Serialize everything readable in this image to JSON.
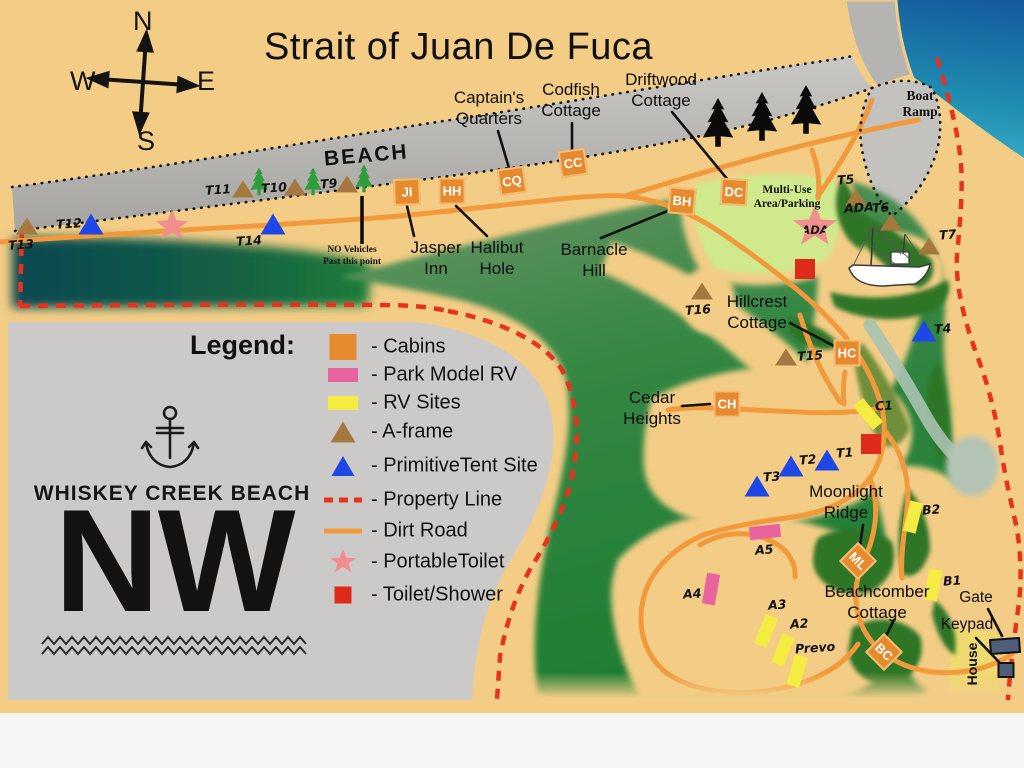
{
  "title": "Strait of Juan De Fuca",
  "compass": {
    "north": "N",
    "east": "E",
    "south": "S",
    "west": "W"
  },
  "labels": {
    "beach": "BEACH",
    "boat_ramp": "Boat\nRamp",
    "no_vehicles": "NO Vehicles\nPast this point",
    "multi_use": "Multi-Use\nArea/Parking",
    "house": "House"
  },
  "logo": {
    "name": "WHISKEY CREEK BEACH",
    "initials": "NW"
  },
  "legend": {
    "heading": "Legend:",
    "items": [
      {
        "key": "cabins",
        "label": "- Cabins",
        "color": "#e78a2e",
        "y": 347
      },
      {
        "key": "park-model",
        "label": "- Park Model RV",
        "color": "#e8649f",
        "y": 375
      },
      {
        "key": "rv-sites",
        "label": "- RV Sites",
        "color": "#f5ec42",
        "y": 403
      },
      {
        "key": "a-frame",
        "label": "- A-frame",
        "color": "#a5793d",
        "y": 432
      },
      {
        "key": "tent",
        "label": "- PrimitiveTent Site",
        "color": "#1f47e6",
        "y": 466
      },
      {
        "key": "property-line",
        "label": "- Property Line",
        "color": "#e8321f",
        "y": 500
      },
      {
        "key": "dirt-road",
        "label": "- Dirt Road",
        "color": "#f2993b",
        "y": 531
      },
      {
        "key": "portable-toilet",
        "label": "- PortableToilet",
        "color": "#f18f8f",
        "y": 562
      },
      {
        "key": "toilet-shower",
        "label": "- Toilet/Shower",
        "color": "#de2a18",
        "y": 595
      }
    ]
  },
  "callouts": [
    {
      "id": "captains-quarters",
      "text": "Captain's\nQuarters",
      "cx": 489,
      "top": 88,
      "leader": [
        498,
        131,
        509,
        168
      ]
    },
    {
      "id": "codfish-cottage",
      "text": "Codfish\nCottage",
      "cx": 571,
      "top": 80,
      "leader": [
        572,
        123,
        572,
        150
      ]
    },
    {
      "id": "driftwood-cottage",
      "text": "Driftwood\nCottage",
      "cx": 661,
      "top": 70,
      "leader": [
        672,
        112,
        728,
        180
      ]
    },
    {
      "id": "barnacle-hill",
      "text": "Barnacle\nHill",
      "cx": 594,
      "top": 240,
      "leader": [
        601,
        238,
        670,
        210
      ]
    },
    {
      "id": "hillcrest-cottage",
      "text": "Hillcrest\nCottage",
      "cx": 757,
      "top": 292,
      "leader": [
        790,
        323,
        834,
        346
      ]
    },
    {
      "id": "cedar-heights",
      "text": "Cedar\nHeights",
      "cx": 652,
      "top": 388,
      "leader": [
        682,
        406,
        710,
        404
      ]
    },
    {
      "id": "jasper-inn",
      "text": "Jasper\nInn",
      "cx": 436,
      "top": 238,
      "leader": [
        414,
        236,
        407,
        206
      ]
    },
    {
      "id": "halibut-hole",
      "text": "Halibut\nHole",
      "cx": 497,
      "top": 238,
      "leader": [
        487,
        236,
        456,
        206
      ]
    },
    {
      "id": "moonlight-ridge",
      "text": "Moonlight\nRidge",
      "cx": 846,
      "top": 482,
      "leader": [
        863,
        525,
        860,
        546
      ]
    },
    {
      "id": "beachcomber-cottage",
      "text": "Beachcomber\nCottage",
      "cx": 877,
      "top": 582,
      "leader": [
        894,
        620,
        886,
        636
      ]
    },
    {
      "id": "gate",
      "text": "Gate",
      "cx": 976,
      "top": 589,
      "small": true,
      "leader": [
        988,
        609,
        1002,
        636
      ]
    },
    {
      "id": "keypad",
      "text": "Keypad",
      "cx": 967,
      "top": 616,
      "small": true,
      "leader": [
        976,
        638,
        999,
        662
      ]
    }
  ],
  "cabins": [
    {
      "code": "JI",
      "x": 407,
      "y": 192,
      "rot": -2
    },
    {
      "code": "HH",
      "x": 452,
      "y": 191,
      "rot": 0
    },
    {
      "code": "CQ",
      "x": 512,
      "y": 181,
      "rot": -8
    },
    {
      "code": "CC",
      "x": 573,
      "y": 163,
      "rot": -8
    },
    {
      "code": "DC",
      "x": 734,
      "y": 192,
      "rot": 3
    },
    {
      "code": "BH",
      "x": 682,
      "y": 201,
      "rot": 5
    },
    {
      "code": "HC",
      "x": 847,
      "y": 353,
      "rot": 0
    },
    {
      "code": "CH",
      "x": 727,
      "y": 404,
      "rot": 0
    },
    {
      "code": "ML",
      "x": 858,
      "y": 561,
      "rot": 45
    },
    {
      "code": "BC",
      "x": 884,
      "y": 652,
      "rot": 45
    }
  ],
  "sites": {
    "aframe": [
      {
        "id": "T13",
        "x": 27,
        "y": 226,
        "lx": 8,
        "ly": 237
      },
      {
        "id": "T11",
        "x": 243,
        "y": 189,
        "lx": 205,
        "ly": 182
      },
      {
        "id": "T10",
        "x": 295,
        "y": 187,
        "lx": 261,
        "ly": 180
      },
      {
        "id": "T9",
        "x": 347,
        "y": 184,
        "lx": 320,
        "ly": 176
      },
      {
        "id": "T16",
        "x": 702,
        "y": 291,
        "lx": 685,
        "ly": 302
      },
      {
        "id": "T15",
        "x": 786,
        "y": 357,
        "lx": 797,
        "ly": 348
      },
      {
        "id": "T5",
        "x": 856,
        "y": 197,
        "lx": 837,
        "ly": 172
      },
      {
        "id": "T6",
        "x": 891,
        "y": 222,
        "lx": 872,
        "ly": 200
      },
      {
        "id": "T7",
        "x": 929,
        "y": 246,
        "lx": 939,
        "ly": 227
      }
    ],
    "tent": [
      {
        "id": "T12",
        "x": 91,
        "y": 224,
        "lx": 56,
        "ly": 216
      },
      {
        "id": "T14",
        "x": 273,
        "y": 224,
        "lx": 236,
        "ly": 233
      },
      {
        "id": "T4",
        "x": 924,
        "y": 331,
        "lx": 934,
        "ly": 321
      },
      {
        "id": "T1",
        "x": 827,
        "y": 460,
        "lx": 836,
        "ly": 445
      },
      {
        "id": "T2",
        "x": 791,
        "y": 466,
        "lx": 799,
        "ly": 452
      },
      {
        "id": "T3",
        "x": 757,
        "y": 486,
        "lx": 763,
        "ly": 469
      }
    ],
    "rv": [
      {
        "id": "C1",
        "x": 868,
        "y": 414,
        "rot": -40,
        "lx": 875,
        "ly": 398
      },
      {
        "id": "B2",
        "x": 913,
        "y": 517,
        "rot": 14,
        "lx": 922,
        "ly": 502
      },
      {
        "id": "B1",
        "x": 933,
        "y": 585,
        "rot": 10,
        "lx": 943,
        "ly": 573
      },
      {
        "id": "A3",
        "x": 766,
        "y": 631,
        "rot": 22,
        "lx": 768,
        "ly": 597
      },
      {
        "id": "A2",
        "x": 783,
        "y": 650,
        "rot": 22,
        "lx": 790,
        "ly": 616
      },
      {
        "id": "Prevo",
        "x": 797,
        "y": 671,
        "rot": 16,
        "lx": 795,
        "ly": 640
      }
    ],
    "park_model": [
      {
        "id": "A5",
        "x": 765,
        "y": 532,
        "rot": 84,
        "lx": 755,
        "ly": 542
      },
      {
        "id": "A4",
        "x": 711,
        "y": 589,
        "rot": 10,
        "lx": 683,
        "ly": 586
      }
    ]
  },
  "facilities": {
    "toilet_shower": [
      {
        "x": 805,
        "y": 269
      },
      {
        "x": 871,
        "y": 444
      }
    ],
    "portable_toilet": [
      {
        "x": 172,
        "y": 226
      }
    ],
    "ada_star": {
      "x": 815,
      "y": 227,
      "label": "ADA"
    },
    "ada_site_label": {
      "text": "ADA",
      "x": 844,
      "y": 200
    },
    "gate_bar": {
      "x": 1005,
      "y": 646
    },
    "keypad_box": {
      "x": 1006,
      "y": 670
    }
  },
  "trees": {
    "black": [
      {
        "x": 718,
        "y": 127
      },
      {
        "x": 762,
        "y": 121
      },
      {
        "x": 806,
        "y": 114
      }
    ],
    "green": [
      {
        "x": 259,
        "y": 184
      },
      {
        "x": 313,
        "y": 184
      },
      {
        "x": 364,
        "y": 181
      }
    ]
  },
  "colors": {
    "sand": "#f3cd86",
    "water_deep": "#15599c",
    "water_shallow": "#86e2ea",
    "beach_gray": "#b3b2af",
    "forest_green": "#1f7e33",
    "parking_green": "#cfe98c",
    "dirt_road": "#f2993b",
    "property_line": "#e8321f",
    "legend_bg": "#cbcac8"
  }
}
